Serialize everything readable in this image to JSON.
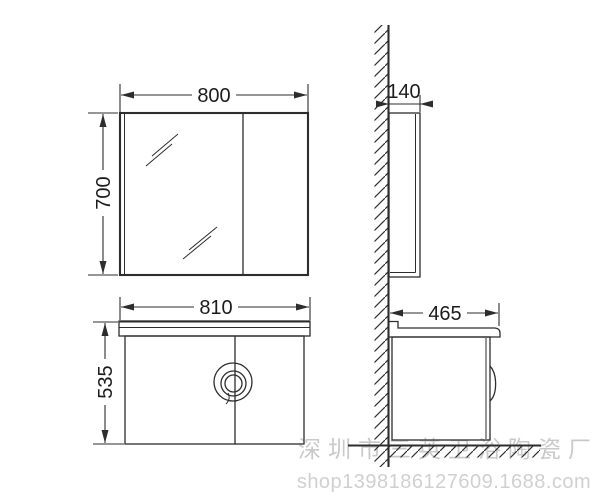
{
  "drawing": {
    "type": "technical-dimension-drawing",
    "subject": "bathroom mirror cabinet and vanity cabinet, front and side views",
    "views": {
      "mirror_front": {
        "width_label": "800",
        "height_label": "700"
      },
      "mirror_side": {
        "depth_label": "140"
      },
      "vanity_front": {
        "width_label": "810",
        "height_label": "535"
      },
      "vanity_side": {
        "depth_label": "465"
      }
    },
    "watermark": {
      "company": "深圳市三英卫浴陶瓷厂",
      "shop_url": "shop1398186127609.1688.com"
    },
    "colors": {
      "line": "#2d2d2d",
      "dimension_text": "#1c1c1c",
      "watermark_company": "#c9c9c9",
      "watermark_url": "#d0d0d0",
      "background": "#ffffff"
    }
  }
}
